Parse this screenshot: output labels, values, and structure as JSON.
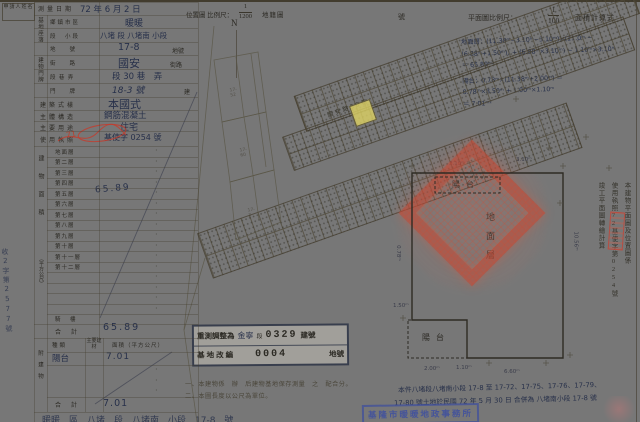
{
  "colors": {
    "paper": "#e9e2d0",
    "ink": "#2c2a24",
    "handwriting": "#27304a",
    "seal_red": "#c44a36",
    "highlight_yellow": "#dcd163",
    "stamp_blue": "#3c4da0"
  },
  "applicant": {
    "label": "申請人姓名"
  },
  "survey": {
    "label": "測量日期",
    "value": "72 年 6 月 2 日"
  },
  "site": {
    "group_label": "基地座落",
    "rows": [
      {
        "label": "鄉鎮市區",
        "value": "暖暖"
      },
      {
        "label": "段　小段",
        "value": "八堵 段 八堵南 小段"
      },
      {
        "label": "地　　號",
        "value": "17-8",
        "suffix": "地號"
      }
    ]
  },
  "door": {
    "group_label": "建物門牌",
    "rows": [
      {
        "label": "街　　路",
        "value": "國安",
        "suffix": "街路"
      },
      {
        "label": "段 巷 弄",
        "value": "段 30 巷　弄"
      },
      {
        "label": "門　　牌",
        "value": "18-3 號",
        "suffix": "建"
      }
    ]
  },
  "attrs": [
    {
      "label": "建築式樣",
      "value": "本國式"
    },
    {
      "label": "主體構造",
      "value": "鋼筋混凝土"
    },
    {
      "label": "主要用途",
      "value": "住宅"
    },
    {
      "label": "使用執照",
      "value": "基使字 0254 號",
      "red_note": "71"
    }
  ],
  "area": {
    "group_label": "建物面積",
    "unit_label": "（平方公尺）",
    "floors": [
      {
        "label": "地面層"
      },
      {
        "label": "第二層"
      },
      {
        "label": "第三層"
      },
      {
        "label": "第四層"
      },
      {
        "label": "第五層"
      },
      {
        "label": "第六層"
      },
      {
        "label": "第七層"
      },
      {
        "label": "第八層"
      },
      {
        "label": "第九層"
      },
      {
        "label": "第十層"
      },
      {
        "label": "第十一層"
      },
      {
        "label": "第十二層"
      },
      {
        "label": ""
      },
      {
        "label": ""
      },
      {
        "label": ""
      },
      {
        "label": ""
      }
    ],
    "ground_area_note": "65.89",
    "arcade_label": "騎　樓",
    "total_label": "合　計",
    "total_value": "65.89"
  },
  "annex": {
    "group_label": "附建物",
    "headers": {
      "kind": "種類",
      "material": "主要建材",
      "area": "面積（平方公尺）"
    },
    "rows": [
      {
        "kind": "陽台",
        "area": "7.01"
      }
    ],
    "total_label": "合　計",
    "total_value": "7.01"
  },
  "margin_note": "收2字第2577號",
  "top": {
    "loc_label": "位置圖 比例尺：",
    "loc_num": "1",
    "loc_den": "1200",
    "loc_suffix": "地籍圖",
    "sheet_no": "號",
    "plan_label": "平面圖比例尺：",
    "plan_num": "1",
    "plan_den": "100",
    "calc_label": "面積計算式"
  },
  "calc": {
    "lines": [
      "地面層：(11.38ᵐ−3.10ᵐ−3.10ᵐ)×(11.0ᵐ −",
      "(6.88ᵐ+1.50ᵐ)) + (6.88ᵐ×3.10ᵐ) − 1.10ᵐ×3.10ᵐ",
      "＝ 65.89ᵐ²",
      "陽台：0.78ᵐ×(11.38ᵐ+2.00ᵐ) ＝",
      "0.78ᵐ×8.50ᵐ + 1.00ᵐ×1.10ᵐ",
      "＝ 7.01ᵐ²"
    ]
  },
  "map": {
    "north": "N",
    "road_label": "國安路30巷",
    "parcel_labels": [
      "17-52",
      "17-60",
      "17-3"
    ]
  },
  "plan": {
    "balcony_top": "陽台",
    "balcony_bottom": "陽台",
    "floor_label": "地面層",
    "dims": {
      "top1": "3.10ᵐ",
      "top2": "3.10ᵐ",
      "right": "10.56ᵐ",
      "left1": "0.78ᵐ",
      "left2": "1.50ᵐ",
      "bottom1": "2.00ᵐ",
      "bottom2": "1.10ᵐ",
      "bottom3": "6.60ᵐ"
    }
  },
  "stamp_box": {
    "row1_label": "重測調整為",
    "row1_name": "金寧",
    "row1_seg": "段",
    "row1_no": "0329",
    "row1_suffix": "建號",
    "row2_label": "基地改編",
    "row2_no": "0004",
    "row2_suffix": "地號"
  },
  "notes": {
    "n1": "一、本建物係　辦　后建物基地保存測量　之　配合分。",
    "n2": "二、本圖長度以公尺為單位。"
  },
  "footer": "暖暖　區　八堵　段　八堵南　小段　17-8　號",
  "hw_note": {
    "l1": "本件八堵段八堵南小段 17-8 至 17-72、17-75、17-76、17-79、",
    "l2": "17-80 號土地於民國 72 年 5 月 30 日 合併為 八堵南小段 17-8 號"
  },
  "right_cols": {
    "c1": "本建物平面圖及位置圖係",
    "c2": "使用執照72基使字第0254號",
    "c3": "竣工平面圖轉繪計算"
  },
  "blue_stamp": "基隆市暖暖地政事務所",
  "license_red": "71"
}
